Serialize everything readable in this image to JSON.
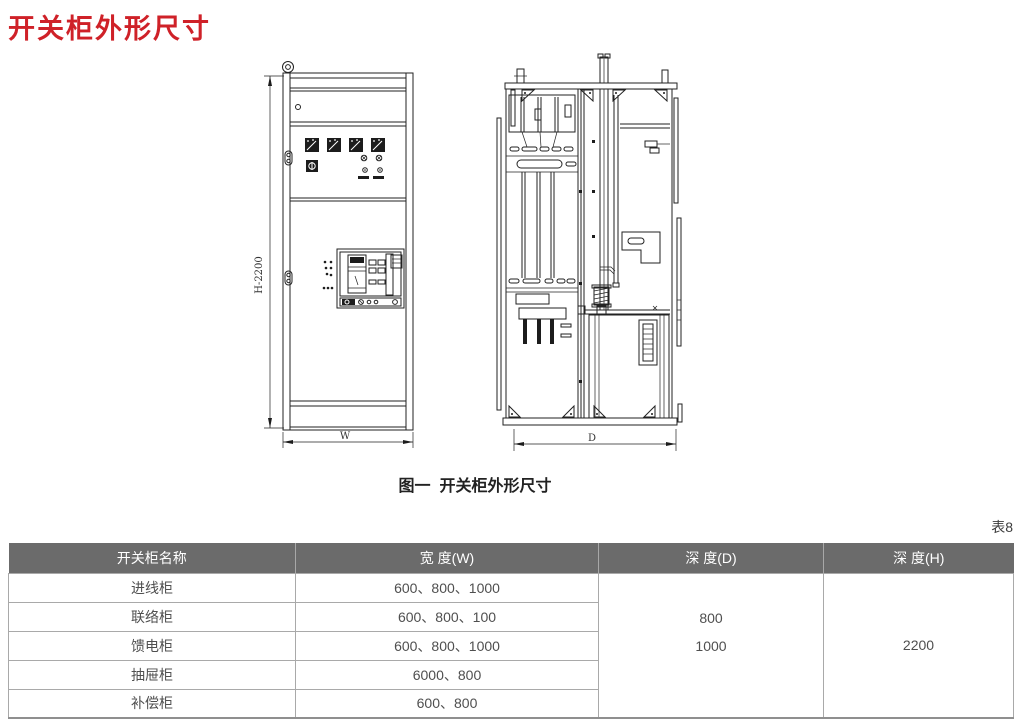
{
  "page": {
    "title": "开关柜外形尺寸",
    "figure_caption": "图一  开关柜外形尺寸",
    "table_label": "表8"
  },
  "drawings": {
    "front_view": {
      "description": "switchgear-cabinet-front-elevation",
      "height_label": "H-2200",
      "width_label": "W"
    },
    "side_view": {
      "description": "switchgear-cabinet-side-section",
      "depth_label": "D"
    }
  },
  "table": {
    "headers": [
      "开关柜名称",
      "宽 度(W)",
      "深 度(D)",
      "深 度(H)"
    ],
    "rows": [
      {
        "name": "进线柜",
        "width": "600、800、1000"
      },
      {
        "name": "联络柜",
        "width": "600、800、100"
      },
      {
        "name": "馈电柜",
        "width": "600、800、1000"
      },
      {
        "name": "抽屉柜",
        "width": "6000、800"
      },
      {
        "name": "补偿柜",
        "width": "600、800"
      }
    ],
    "depth_d": [
      "800",
      "1000"
    ],
    "depth_h": "2200"
  },
  "colors": {
    "title_red": "#cf2128",
    "header_bg": "#6b6b6b",
    "header_text": "#ffffff",
    "body_text": "#4f4f4f",
    "table_border": "#a9a9a9",
    "drawing_stroke": "#222222"
  }
}
